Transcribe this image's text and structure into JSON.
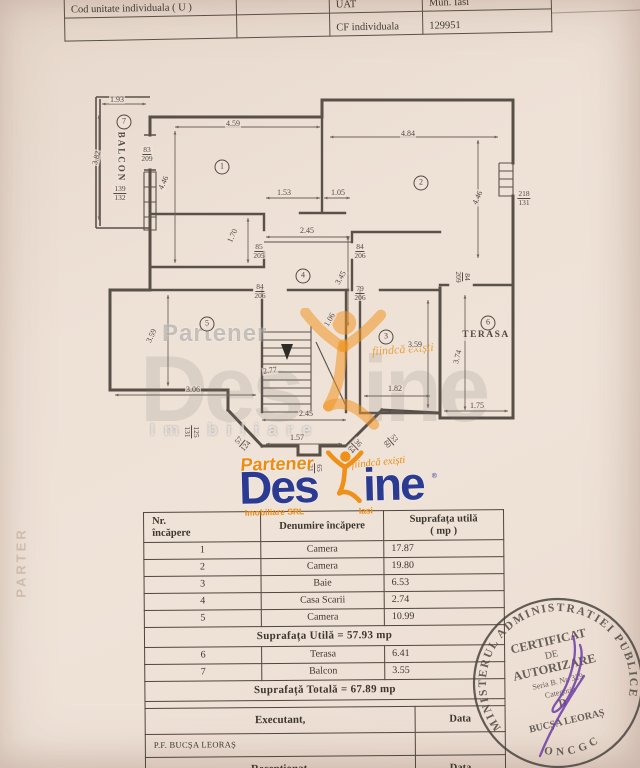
{
  "header_table": {
    "rows": [
      {
        "cells": [
          {
            "t": "Cod unitate individuala ( U )"
          },
          {
            "t": ""
          },
          {
            "t": "UAT"
          },
          {
            "t": "Mun. Iasi"
          }
        ]
      },
      {
        "cells": [
          {
            "t": ""
          },
          {
            "t": ""
          },
          {
            "t": "CF individuala"
          },
          {
            "t": "129951"
          }
        ]
      }
    ]
  },
  "plan": {
    "labels": [
      {
        "t": "1.93",
        "x": 117,
        "y": 100
      },
      {
        "t": "7",
        "x": 124,
        "y": 122,
        "c": true
      },
      {
        "t": "BALCON",
        "x": 121,
        "y": 157,
        "r": 90,
        "fs": 9,
        "ls": 2,
        "b": true
      },
      {
        "t": "3.82",
        "x": 97,
        "y": 158,
        "r": -75
      },
      {
        "top": "83",
        "bot": "209",
        "x": 147,
        "y": 154
      },
      {
        "top": "139",
        "bot": "132",
        "x": 120,
        "y": 193
      },
      {
        "t": "4.59",
        "x": 233,
        "y": 124
      },
      {
        "t": "1",
        "x": 222,
        "y": 167,
        "c": true
      },
      {
        "t": "4.46",
        "x": 164,
        "y": 183,
        "r": -65
      },
      {
        "t": "1.53",
        "x": 284,
        "y": 193
      },
      {
        "t": "1.05",
        "x": 338,
        "y": 193
      },
      {
        "t": "4.84",
        "x": 408,
        "y": 134
      },
      {
        "t": "2",
        "x": 421,
        "y": 183,
        "c": true
      },
      {
        "t": "4.46",
        "x": 478,
        "y": 198,
        "r": -65
      },
      {
        "top": "218",
        "bot": "131",
        "x": 524,
        "y": 198
      },
      {
        "t": "1.70",
        "x": 233,
        "y": 236,
        "r": -65
      },
      {
        "t": "2.45",
        "x": 307,
        "y": 231
      },
      {
        "top": "85",
        "bot": "205",
        "x": 259,
        "y": 251
      },
      {
        "top": "84",
        "bot": "206",
        "x": 360,
        "y": 251
      },
      {
        "t": "4",
        "x": 303,
        "y": 276,
        "c": true
      },
      {
        "t": "3.45",
        "x": 341,
        "y": 278,
        "r": -60
      },
      {
        "top": "84",
        "bot": "206",
        "x": 260,
        "y": 291
      },
      {
        "top": "79",
        "bot": "206",
        "x": 360,
        "y": 293
      },
      {
        "top": "84",
        "bot": "209",
        "x": 463,
        "y": 277,
        "r": 90
      },
      {
        "t": "5",
        "x": 207,
        "y": 324,
        "c": true
      },
      {
        "t": "3.59",
        "x": 152,
        "y": 336,
        "r": -65
      },
      {
        "t": "3",
        "x": 386,
        "y": 337,
        "c": true
      },
      {
        "t": "3.59",
        "x": 415,
        "y": 345
      },
      {
        "t": "6",
        "x": 488,
        "y": 323,
        "c": true
      },
      {
        "t": "TERASA",
        "x": 486,
        "y": 336,
        "fs": 9.5,
        "ls": 1.5,
        "b": true
      },
      {
        "t": "3.74",
        "x": 458,
        "y": 357,
        "r": -75
      },
      {
        "t": "1.06",
        "x": 330,
        "y": 320,
        "r": -60
      },
      {
        "t": "2.77",
        "x": 270,
        "y": 371,
        "r": -8
      },
      {
        "t": "3.06",
        "x": 193,
        "y": 390
      },
      {
        "t": "1.82",
        "x": 395,
        "y": 389
      },
      {
        "t": "2.45",
        "x": 306,
        "y": 414
      },
      {
        "t": "1.75",
        "x": 477,
        "y": 406
      },
      {
        "t": "1.57",
        "x": 297,
        "y": 438
      },
      {
        "top": "125",
        "bot": "131",
        "x": 192,
        "y": 432,
        "r": 90
      },
      {
        "top": "57",
        "bot": "124",
        "x": 242,
        "y": 443,
        "r": -50
      },
      {
        "top": "36",
        "bot": "64",
        "x": 355,
        "y": 446,
        "r": 45
      },
      {
        "top": "53",
        "bot": "60",
        "x": 391,
        "y": 441,
        "r": 50
      },
      {
        "top": "65",
        "bot": "21",
        "x": 315,
        "y": 468,
        "r": 90
      }
    ]
  },
  "watermark": {
    "partener": "Partener",
    "des": "Des",
    "ine": "ine",
    "imobiliare": "Imobiliare",
    "tagline": "fiindcă exiști"
  },
  "logo": {
    "partener": "Partener",
    "des": "Des",
    "ine": "ine",
    "reg": "®",
    "tagline": "fiindcă exiști",
    "imobiliare": "Imobiliare SRL",
    "iasi": "Iasi"
  },
  "area_table": {
    "rows": [
      {
        "cls": "hdr",
        "cells": [
          {
            "t": "Nr.\nîncăpere",
            "cls": "left"
          },
          {
            "t": "Denumire încăpere"
          },
          {
            "t": "Suprafața utilă\n( mp )",
            "span": 2
          }
        ]
      },
      {
        "cells": [
          {
            "t": "1"
          },
          {
            "t": "Camera"
          },
          {
            "t": "17.87",
            "span": 2,
            "cls": "val"
          }
        ]
      },
      {
        "cells": [
          {
            "t": "2"
          },
          {
            "t": "Camera"
          },
          {
            "t": "19.80",
            "span": 2,
            "cls": "val"
          }
        ]
      },
      {
        "cells": [
          {
            "t": "3"
          },
          {
            "t": "Baie"
          },
          {
            "t": "6.53",
            "span": 2,
            "cls": "val"
          }
        ]
      },
      {
        "cells": [
          {
            "t": "4"
          },
          {
            "t": "Casa Scarii"
          },
          {
            "t": "2.74",
            "span": 2,
            "cls": "val"
          }
        ]
      },
      {
        "cells": [
          {
            "t": "5"
          },
          {
            "t": "Camera"
          },
          {
            "t": "10.99",
            "span": 2,
            "cls": "val"
          }
        ]
      },
      {
        "cls": "merge",
        "cells": [
          {
            "t": "Suprafața Utilă = 57.93 mp",
            "span": 4
          }
        ]
      },
      {
        "cells": [
          {
            "t": "6"
          },
          {
            "t": "Terasa"
          },
          {
            "t": "6.41",
            "span": 2,
            "cls": "val"
          }
        ]
      },
      {
        "cells": [
          {
            "t": "7"
          },
          {
            "t": "Balcon"
          },
          {
            "t": "3.55",
            "span": 2,
            "cls": "val"
          }
        ]
      },
      {
        "cls": "merge",
        "cells": [
          {
            "t": "Suprafață Totală = 67.89 mp",
            "span": 4
          }
        ]
      },
      {
        "cls": "spacer",
        "cells": [
          {
            "t": "",
            "span": 4
          }
        ]
      },
      {
        "cls": "exec",
        "cells": [
          {
            "t": "Executant,",
            "span": 3,
            "cls": "execlbl"
          },
          {
            "t": "Data",
            "cls": "datalbl"
          }
        ]
      },
      {
        "cls": "name",
        "cells": [
          {
            "t": "P.F. BUCȘA LEORAȘ",
            "span": 3,
            "cls": "namecell"
          },
          {
            "t": ""
          }
        ]
      },
      {
        "cls": "exec",
        "cells": [
          {
            "t": "Recepționat,",
            "span": 3,
            "cls": "execlbl"
          },
          {
            "t": "Data",
            "cls": "datalbl"
          }
        ]
      }
    ]
  },
  "stamp": {
    "ring_top": "MINISTERUL ADMINISTRATIEI PUBLICE",
    "ring_bottom": "ONCGC",
    "line1": "CERTIFICAT",
    "line2": "DE",
    "line3": "AUTORIZARE",
    "line4": "Seria B. Nr. 329",
    "line5": "Categoria",
    "line6": "D",
    "line7": "BUCȘA LEORAȘ"
  },
  "side_text": "PARTER"
}
